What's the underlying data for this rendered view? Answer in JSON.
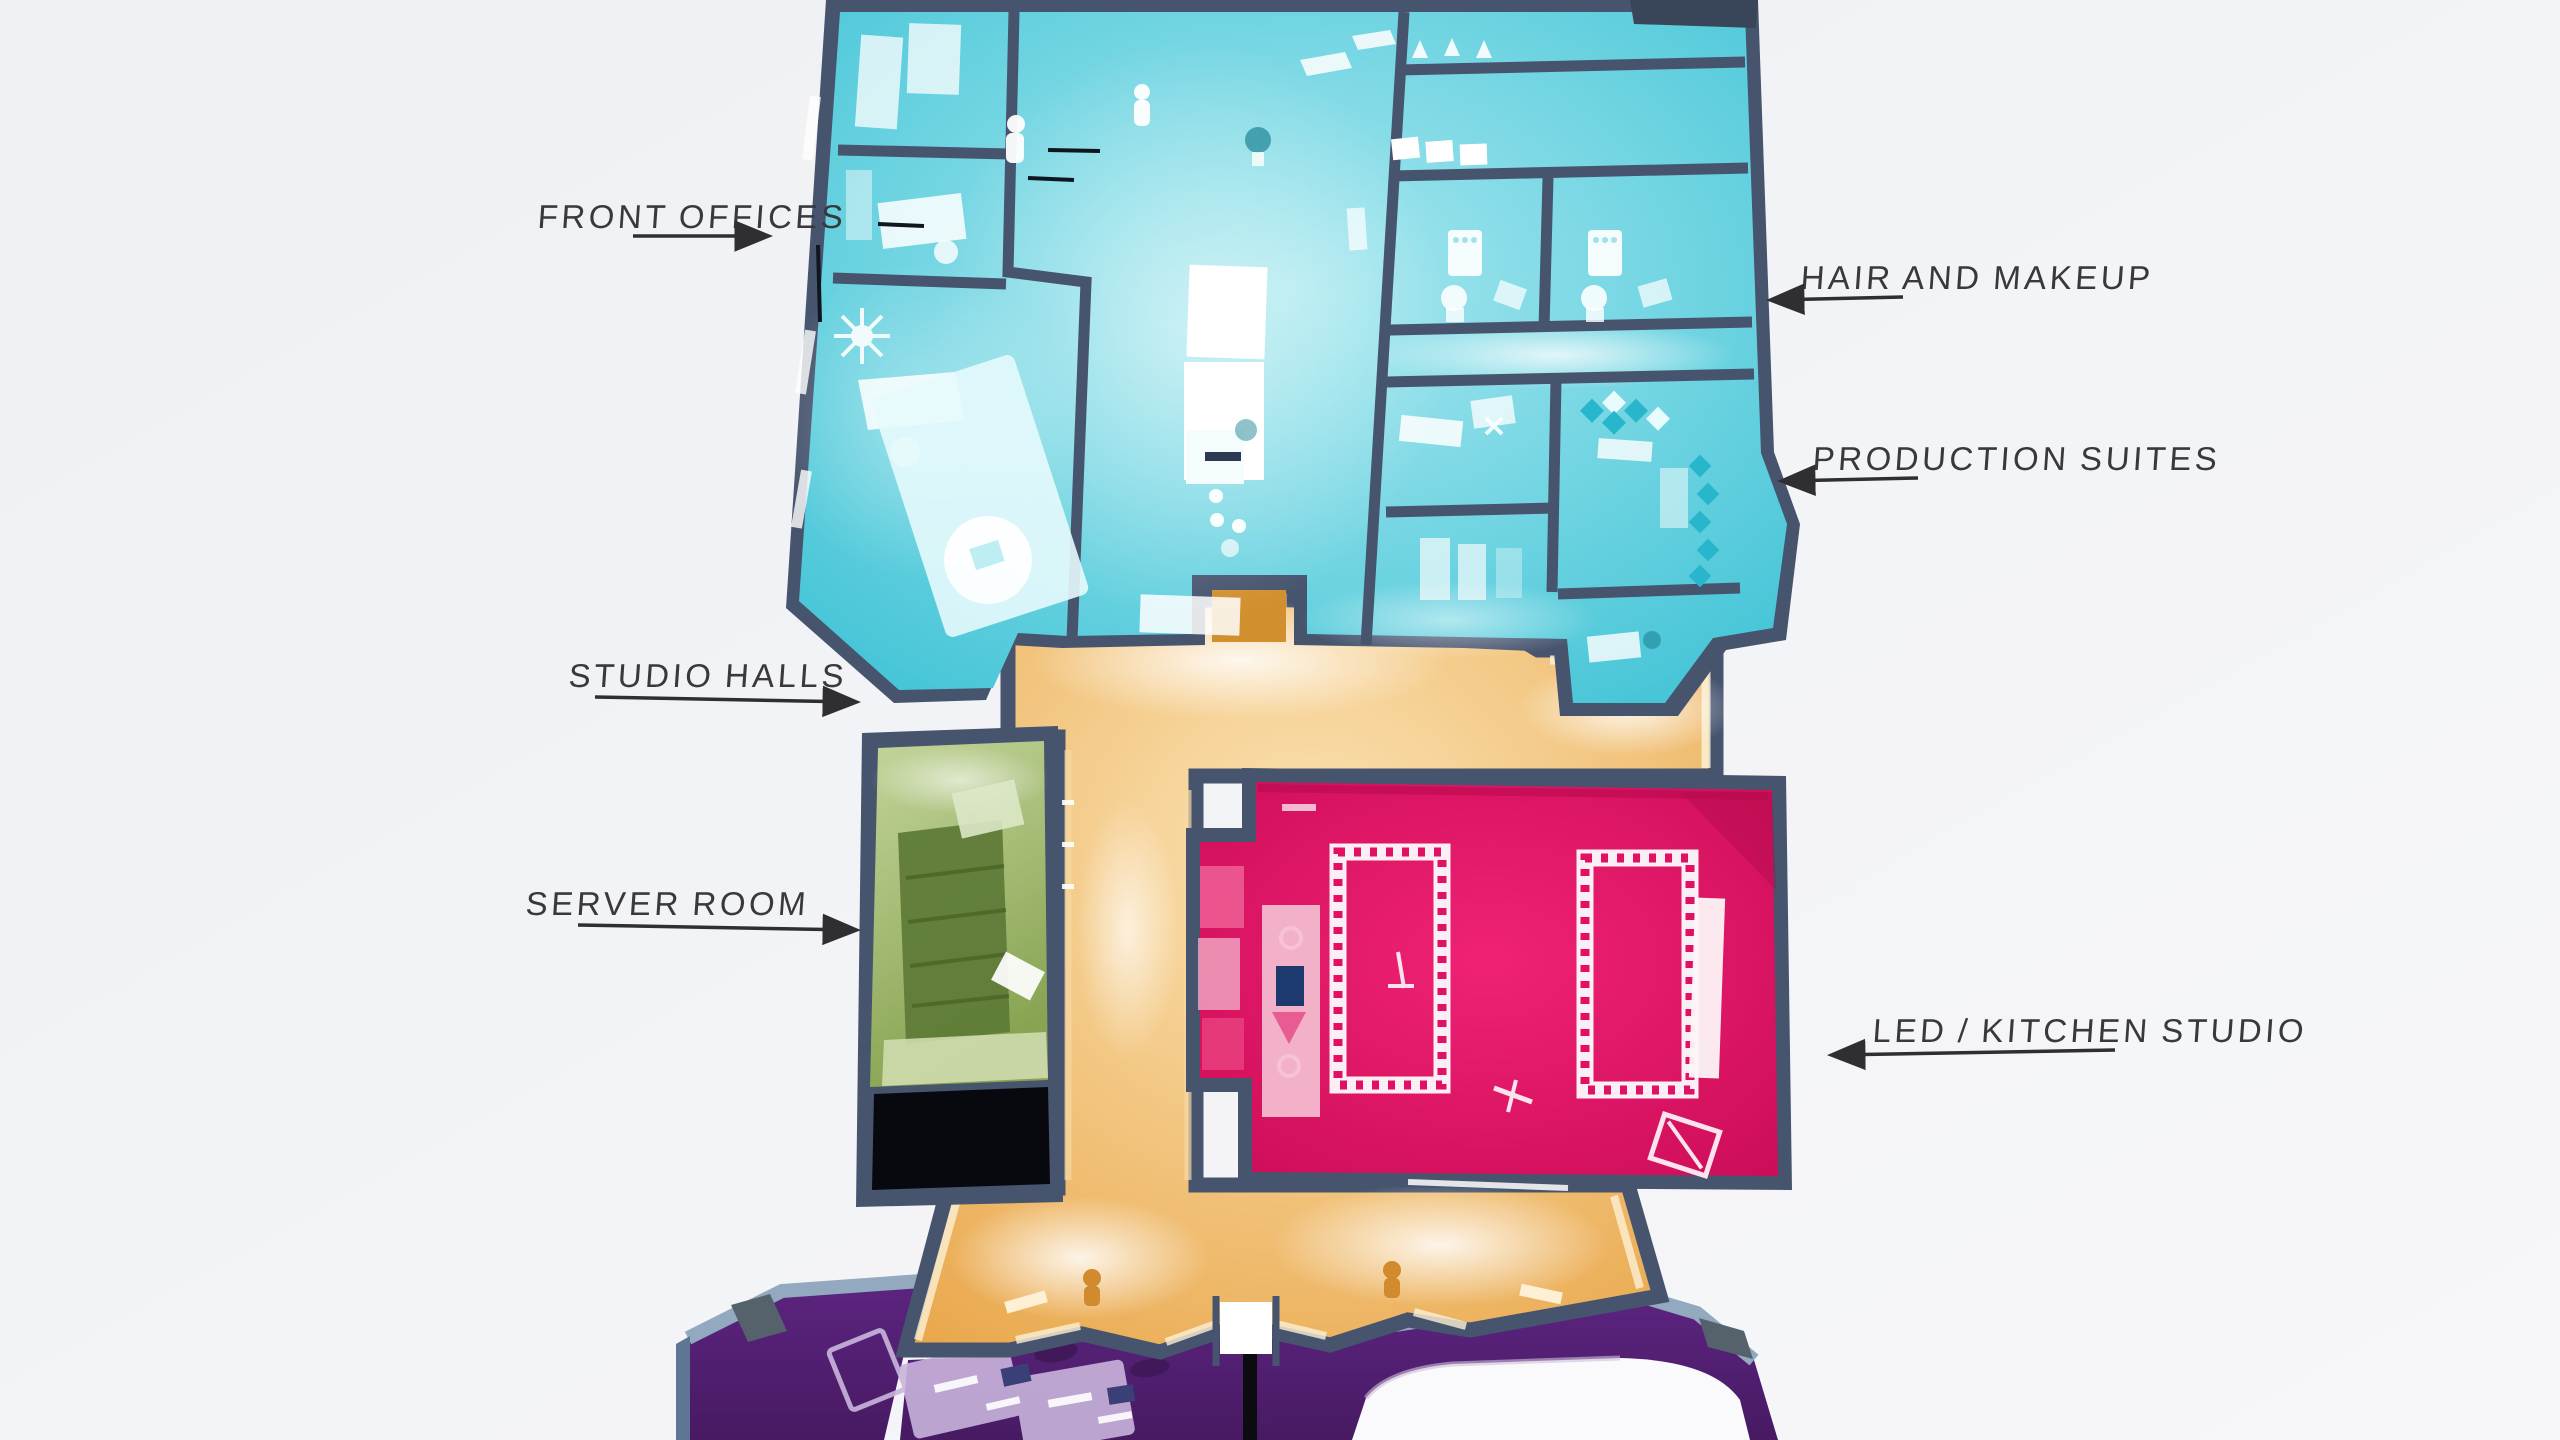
{
  "scene": {
    "type": "isometric-floorplan",
    "description": "Cutaway 3D floor plan of a broadcast studio facility",
    "background_color": "#f1f2f5",
    "wall_color": "#46546e",
    "wall_top_light_color": "#92a9bf",
    "label_text_color": "#38383d",
    "black_room_color": "#08090e",
    "white_cyclorama_color": "#fafafc"
  },
  "sections": {
    "front_offices": {
      "label": "FRONT OFFICES",
      "color": "#3fc3d6",
      "arrow": "right"
    },
    "hair_and_makeup": {
      "label": "HAIR AND MAKEUP",
      "color": "#3fc3d6",
      "arrow": "left"
    },
    "production_suites": {
      "label": "PRODUCTION SUITES",
      "color": "#3fc3d6",
      "arrow": "left"
    },
    "studio_halls": {
      "label": "STUDIO HALLS",
      "color": "#e9a74b",
      "arrow": "right"
    },
    "server_room": {
      "label": "SERVER ROOM",
      "color": "#88a452",
      "arrow": "right"
    },
    "led_kitchen_studio": {
      "label": "LED / KITCHEN STUDIO",
      "color": "#e50f64",
      "arrow": "left"
    },
    "lower_studio": {
      "label": "",
      "color": "#5c2480",
      "arrow": ""
    }
  }
}
